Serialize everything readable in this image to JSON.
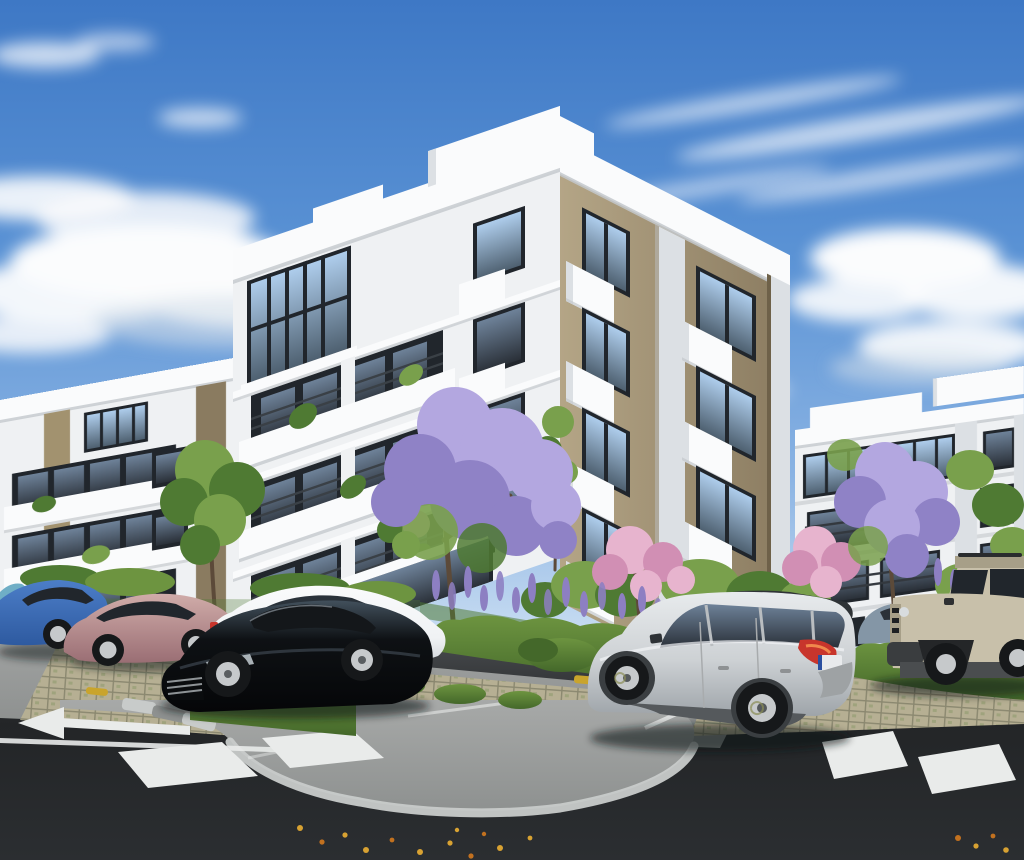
{
  "scene": {
    "label": "3D architectural rendering of a modern residential apartment complex with landscaped parking area and parked cars",
    "image": {
      "width": 1024,
      "height": 860,
      "kind": "exterior-render"
    },
    "objects": [
      {
        "name": "sky",
        "desc": "blue sky with scattered white clouds"
      },
      {
        "name": "building-central",
        "desc": "five-story apartment block, white bands and tan panels, balconies"
      },
      {
        "name": "building-left",
        "desc": "four-story white apartment block with balconies and tan strips"
      },
      {
        "name": "building-far-left",
        "desc": "partial white block at frame edge"
      },
      {
        "name": "building-right",
        "desc": "four-story white apartment block with dark glazing bands"
      },
      {
        "name": "jacaranda-tree-center",
        "desc": "purple flowering tree"
      },
      {
        "name": "jacaranda-tree-right",
        "desc": "purple flowering tree"
      },
      {
        "name": "pink-blossom-trees",
        "desc": "pink flowering trees"
      },
      {
        "name": "green-tree-left",
        "desc": "green tree in front of left building"
      },
      {
        "name": "lavender-beds",
        "desc": "purple lavender planting beds"
      },
      {
        "name": "hedges",
        "desc": "low trimmed green hedges"
      },
      {
        "name": "parking-pavers",
        "desc": "tan grass-paver parking strips"
      },
      {
        "name": "concrete-apron",
        "desc": "curved light concrete sidewalk apron"
      },
      {
        "name": "asphalt-road",
        "desc": "dark asphalt roadway"
      },
      {
        "name": "road-arrow",
        "desc": "white straight-ahead arrow marking"
      },
      {
        "name": "crosswalks",
        "desc": "white crosswalk blocks left and right"
      },
      {
        "name": "fallen-leaves",
        "desc": "scattered yellow leaves on asphalt"
      }
    ],
    "vehicles": [
      {
        "name": "car-teal-sliver",
        "desc": "edge of teal hatchback",
        "color": "#6FAEC6"
      },
      {
        "name": "car-blue-sedan",
        "desc": "blue sedan",
        "color": "#4C7EC8"
      },
      {
        "name": "car-rose-sedan",
        "desc": "rose-bronze sedan",
        "color": "#B98E92"
      },
      {
        "name": "car-white-sedan",
        "desc": "white fastback sedan",
        "color": "#F0F2F4"
      },
      {
        "name": "car-black-sedan",
        "desc": "black fastback sedan with chrome grille",
        "color": "#0E1114"
      },
      {
        "name": "car-gray-blue",
        "desc": "gray-blue car behind SUV",
        "color": "#8496A6"
      },
      {
        "name": "suv-silver-captur",
        "desc": "silver crossover with black roof, red taillight, white license plate",
        "color": "#CDD1D4"
      },
      {
        "name": "suv-beige-boxy",
        "desc": "beige boxy SUV with black trim",
        "color": "#C8C0AA"
      }
    ]
  },
  "palette": {
    "sky_top": "#3E78C5",
    "sky_mid": "#5B93D5",
    "sky_low": "#8AB3E3",
    "sky_horizon": "#D9E8F6",
    "cloud_white": "#FBFCFD",
    "cloud_shade": "#D3DEE9",
    "parapet_white": "#FAFBFC",
    "wall_white": "#EFF1F3",
    "wall_shade": "#DCE0E4",
    "wall_dark": "#C3C8CC",
    "tan_light": "#B4A586",
    "tan_dark": "#8A7B60",
    "tan_strip": "#A2926F",
    "frame_dark": "#21262C",
    "glass_light": "#AECDEC",
    "glass_dark": "#4E6070",
    "asphalt_light": "#54575A",
    "asphalt_dark": "#232527",
    "concrete": "#A7A9A8",
    "concrete_shade": "#8E9190",
    "curb_light": "#C8CBCA",
    "paver_light": "#B6AF93",
    "paver_line": "#8B8870",
    "hedge_light": "#6D9440",
    "hedge_dark": "#44682A",
    "foliage_light": "#79A04C",
    "foliage_dark": "#4F7A33",
    "jacaranda_light": "#B3A7E0",
    "jacaranda_dark": "#8F82C6",
    "lavender": "#8D7FC2",
    "pink_light": "#E7B4CE",
    "pink_dark": "#D18FB4",
    "trunk_brown": "#5C4A39",
    "marking_white": "#E9EBEA",
    "wheel_stop_yellow": "#C9A42C",
    "leaf_yellow": "#D8A232",
    "leaf_orange": "#C2711F",
    "car_teal": "#6FAEC6",
    "car_blue": "#4C7EC8",
    "car_blue_dark": "#2E5AA0",
    "car_rose": "#B98E92",
    "car_rose_dark": "#9A6E74",
    "car_white": "#F0F2F4",
    "car_white_shade": "#C9CED3",
    "car_black": "#0E1114",
    "car_black_highlight": "#42505C",
    "car_silver": "#CDD1D4",
    "car_silver_shade": "#9EA4A9",
    "car_roof_dark": "#2F3336",
    "car_beige": "#C8C0AA",
    "car_beige_shade": "#A79F88",
    "car_gray_blue": "#8496A6",
    "taillight_red": "#C8352C",
    "tire_dark": "#16181A",
    "rim_silver": "#C6C9CB",
    "plate_white": "#E8EAEC",
    "shadow": "#101316"
  }
}
